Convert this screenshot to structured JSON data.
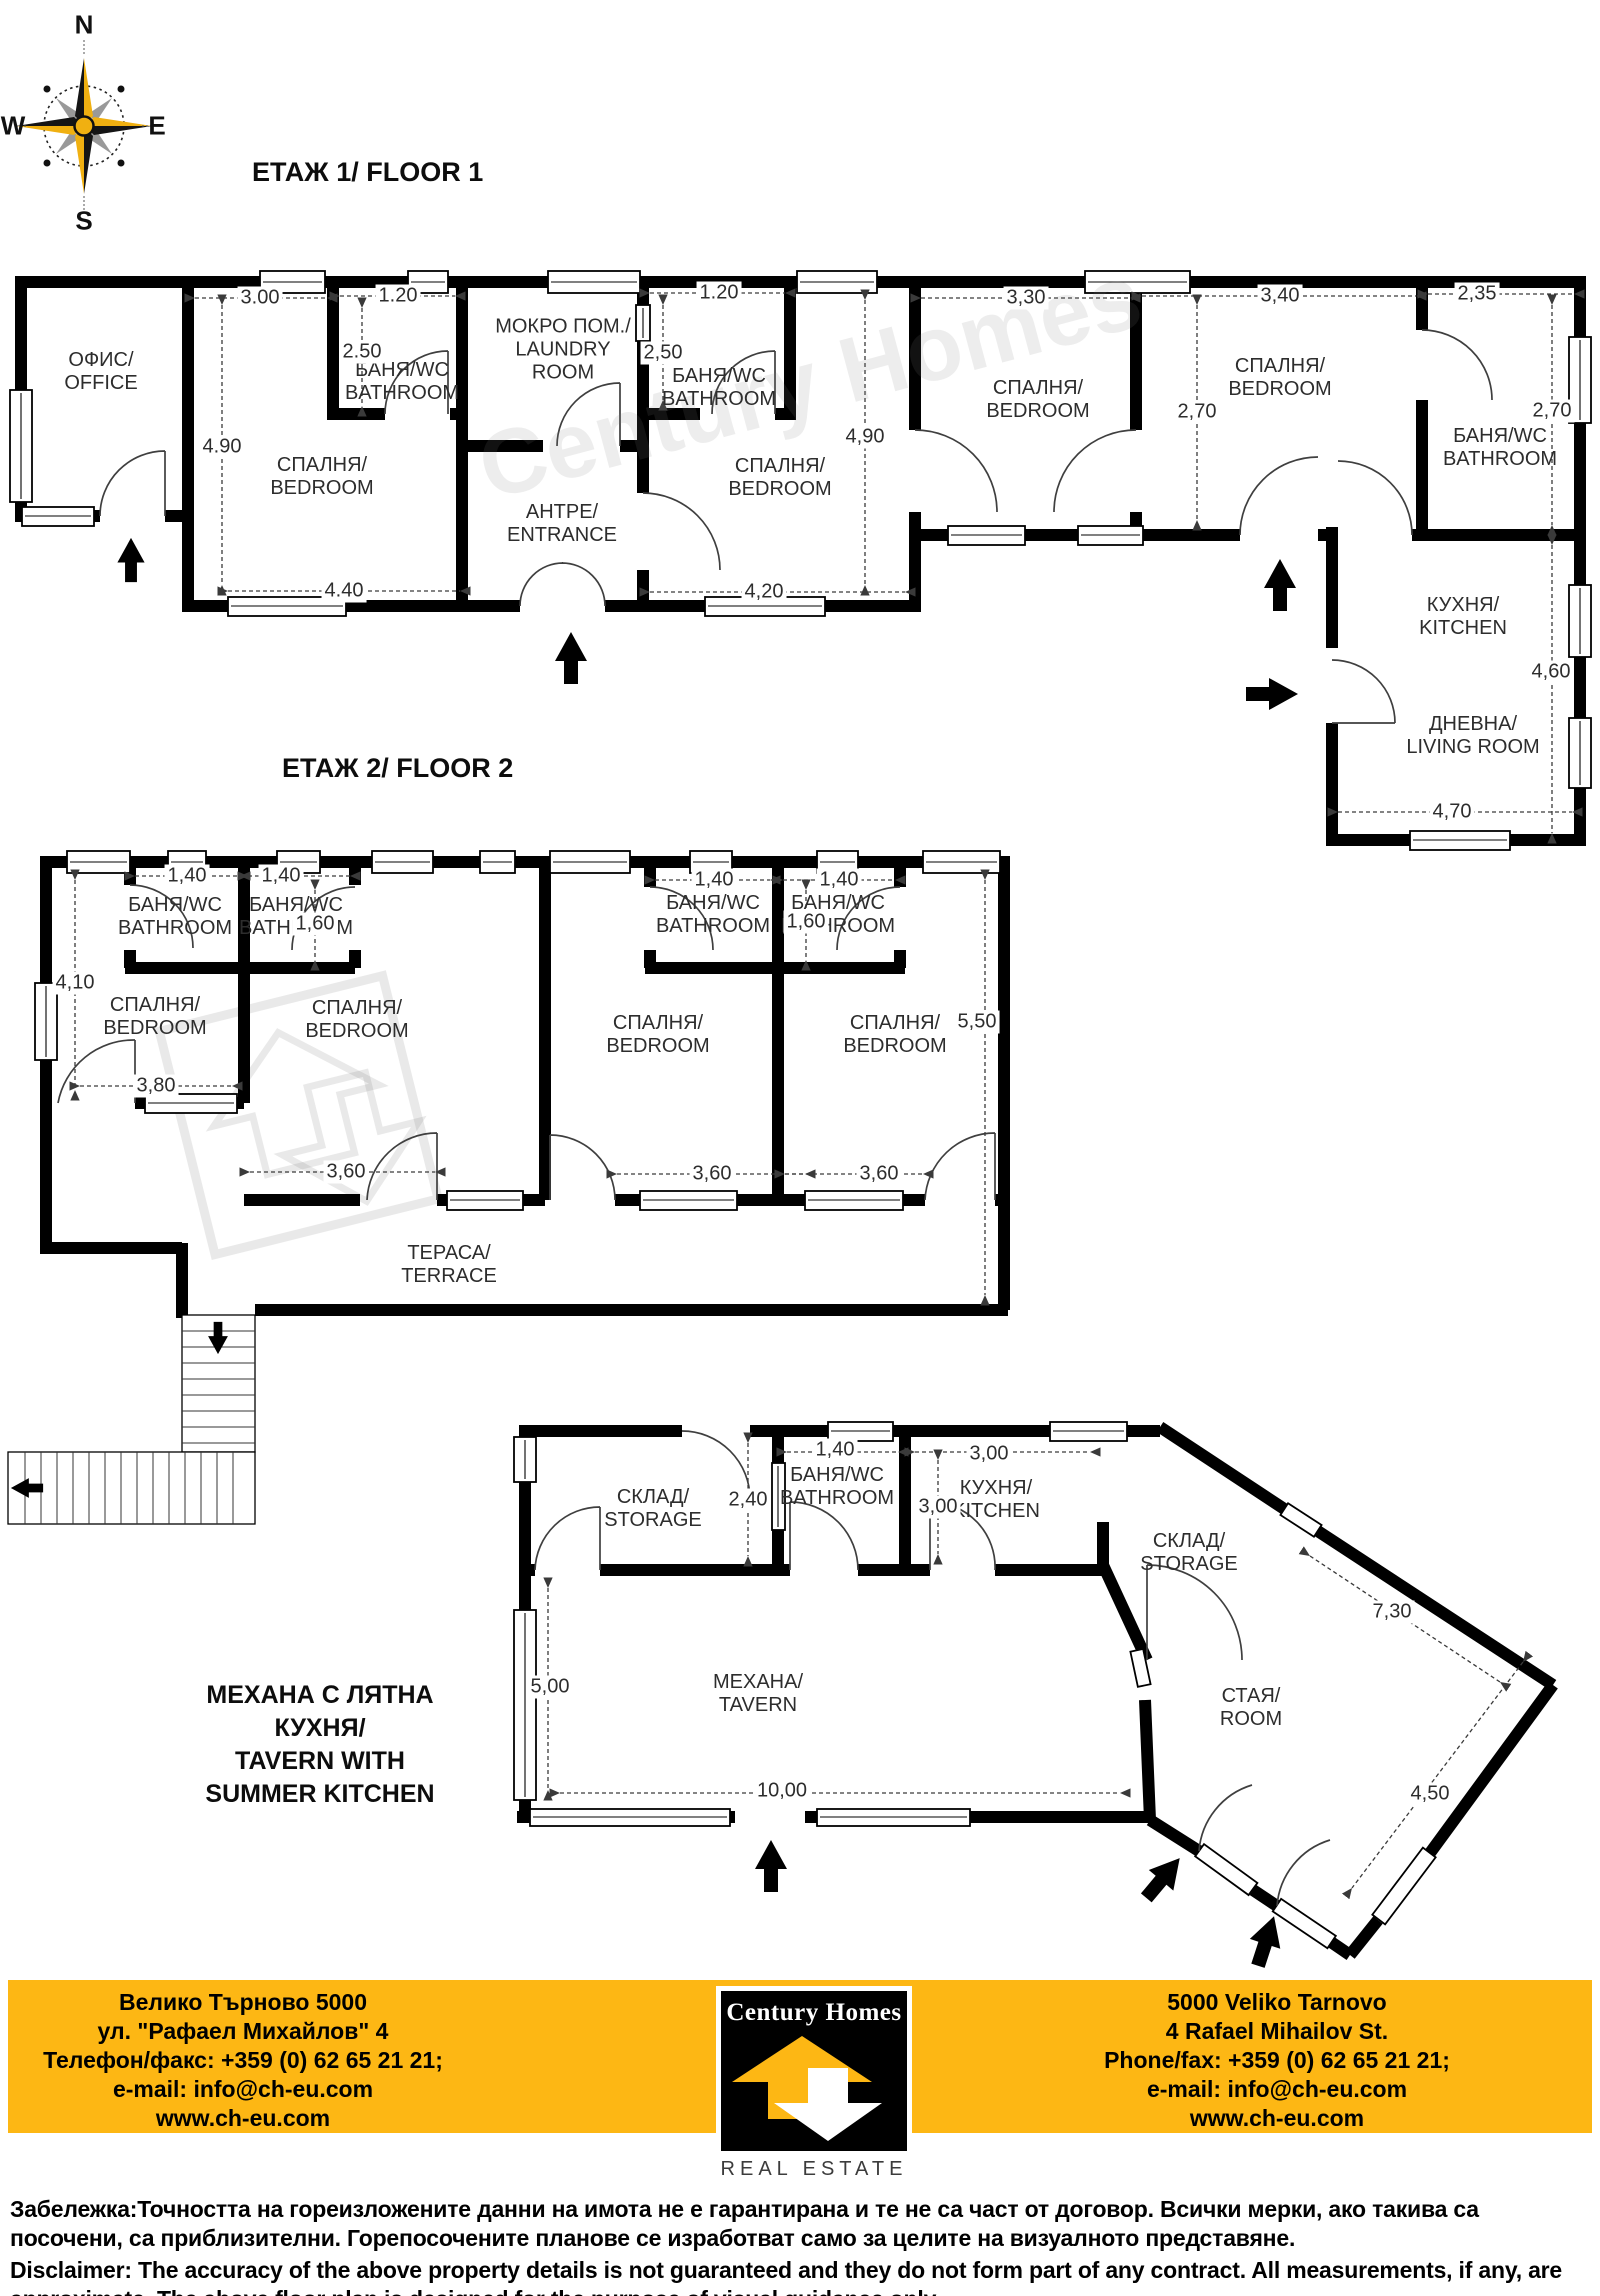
{
  "watermark": "Century Homes",
  "compass": {
    "n": "N",
    "e": "E",
    "s": "S",
    "w": "W"
  },
  "floor1": {
    "title": "ЕТАЖ 1/ FLOOR 1",
    "rooms": {
      "office": [
        "ОФИС/",
        "OFFICE"
      ],
      "bedroom1": [
        "СПАЛНЯ/",
        "BEDROOM"
      ],
      "bath1": [
        "БАНЯ/WC",
        "BATHROOM"
      ],
      "laundry": [
        "МОКРО ПОМ./",
        "LAUNDRY",
        "ROOM"
      ],
      "entrance": [
        "АНТРЕ/",
        "ENTRANCE"
      ],
      "bath2": [
        "БАНЯ/WC",
        "BATHROOM"
      ],
      "bedroom2": [
        "СПАЛНЯ/",
        "BEDROOM"
      ],
      "bedroom3": [
        "СПАЛНЯ/",
        "BEDROOM"
      ],
      "bedroom4": [
        "СПАЛНЯ/",
        "BEDROOM"
      ],
      "bath3": [
        "БАНЯ/WC",
        "BATHROOM"
      ],
      "kitchen": [
        "КУХНЯ/",
        "KITCHEN"
      ],
      "living": [
        "ДНЕВНА/",
        "LIVING ROOM"
      ]
    },
    "dims": {
      "bedroom1_w": "3.00",
      "bath1_w": "1.20",
      "bath1_h": "2.50",
      "bedroom1_h": "4.90",
      "bedroom1_b": "4.40",
      "bath2_w": "1.20",
      "bath2_h": "2,50",
      "bedroom2_h": "4,90",
      "bedroom2_w": "4,20",
      "bedroom3_w": "3,30",
      "bedroom4_w": "3,40",
      "bath3_w": "2,35",
      "bedroom4_h": "2,70",
      "bath3_h": "2,70",
      "kitchen_h": "4,60",
      "kitchen_w": "4,70"
    }
  },
  "floor2": {
    "title": "ЕТАЖ 2/ FLOOR 2",
    "rooms": {
      "bath1": [
        "БАНЯ/WC",
        "BATHROOM"
      ],
      "bath2": [
        "БАНЯ/WC",
        "BATHROOM"
      ],
      "bath3": [
        "БАНЯ/WC",
        "BATHROOM"
      ],
      "bath4": [
        "БАНЯ/WC",
        "BATHROOM"
      ],
      "bedroom1": [
        "СПАЛНЯ/",
        "BEDROOM"
      ],
      "bedroom2": [
        "СПАЛНЯ/",
        "BEDROOM"
      ],
      "bedroom3": [
        "СПАЛНЯ/",
        "BEDROOM"
      ],
      "bedroom4": [
        "СПАЛНЯ/",
        "BEDROOM"
      ],
      "terrace": [
        "ТЕРАСА/",
        "TERRACE"
      ]
    },
    "dims": {
      "bath1_w": "1,40",
      "bath2_w": "1,40",
      "bath2_h": "1,60",
      "bath3_w": "1,40",
      "bath4_w": "1,40",
      "bath4_h": "1,60",
      "bedroom1_h": "4,10",
      "bedroom1_w": "3,80",
      "bedroom2_w": "3,60",
      "bedroom3_w": "3,60",
      "bedroom4_w": "3,60",
      "bedroom4_h": "5,50"
    }
  },
  "tavern": {
    "title": [
      "МЕХАНА С ЛЯТНА",
      "КУХНЯ/",
      "TAVERN WITH",
      "SUMMER KITCHEN"
    ],
    "rooms": {
      "storage1": [
        "СКЛАД/",
        "STORAGE"
      ],
      "bath": [
        "БАНЯ/WC",
        "BATHROOM"
      ],
      "kitchen": [
        "КУХНЯ/",
        "KITCHEN"
      ],
      "storage2": [
        "СКЛАД/",
        "STORAGE"
      ],
      "tavern": [
        "МЕХАНА/",
        "TAVERN"
      ],
      "room": [
        "СТАЯ/",
        "ROOM"
      ]
    },
    "dims": {
      "storage1_h": "2,40",
      "bath_w": "1,40",
      "kitchen_w": "3,00",
      "kitchen_h": "3,00",
      "tavern_h": "5,00",
      "tavern_w": "10,00",
      "room_l": "7,30",
      "room_w": "4,50"
    }
  },
  "footer": {
    "accent_color": "#FDB714",
    "left_lines": [
      "Велико Търново 5000",
      "ул. \"Рафаел Михайлов\" 4",
      "Телефон/факс: +359 (0) 62 65 21 21;",
      "e-mail: info@ch-eu.com",
      "www.ch-eu.com"
    ],
    "right_lines": [
      "5000 Veliko Tarnovo",
      "4 Rafael Mihailov St.",
      "Phone/fax: +359 (0) 62 65 21 21;",
      "e-mail: info@ch-eu.com",
      "www.ch-eu.com"
    ],
    "logo_brand": "Century Homes",
    "logo_tagline": "REAL ESTATE"
  },
  "disclaimer": {
    "bg": "Забележка:Точността на гореизложените данни на имота не е гарантирана и те не са част от договор. Всички мерки, ако такива са посочени, са приблизителни. Горепосочените планове се изработват само за целите на визуалното представяне.",
    "en": "Disclaimer: The accuracy of the above property details is not guaranteed and they do not form part of any contract. All measurements, if any, are approximate. The above floor plan is designed for the purpose of visual guidance only."
  }
}
